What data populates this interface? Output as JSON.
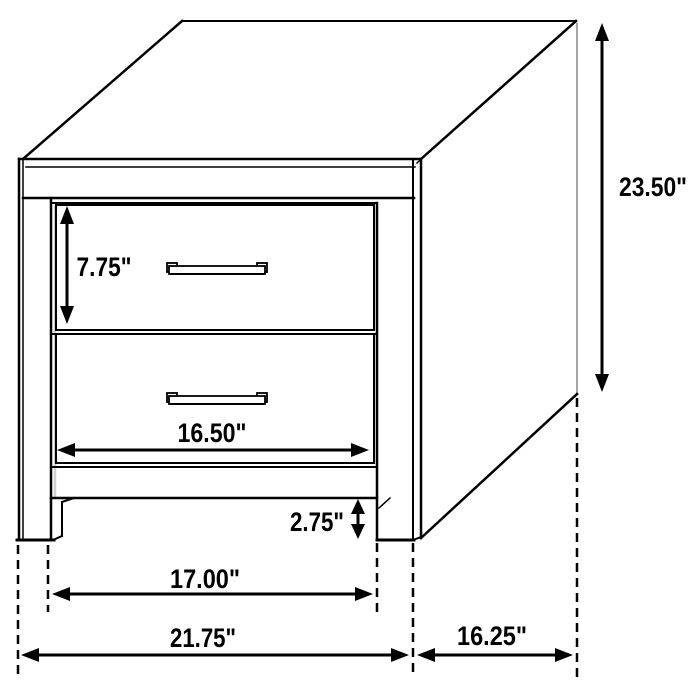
{
  "diagram": {
    "subject": "two-drawer nightstand dimension drawing",
    "background": "#ffffff",
    "line_color": "#000000",
    "back_edge_color": "#a6a6a6",
    "labels": {
      "drawer_height": "7.75\"",
      "overall_height": "23.50\"",
      "drawer_width": "16.50\"",
      "base_clearance": "2.75\"",
      "leg_inner_width": "17.00\"",
      "overall_width": "21.75\"",
      "overall_depth": "16.25\""
    }
  }
}
